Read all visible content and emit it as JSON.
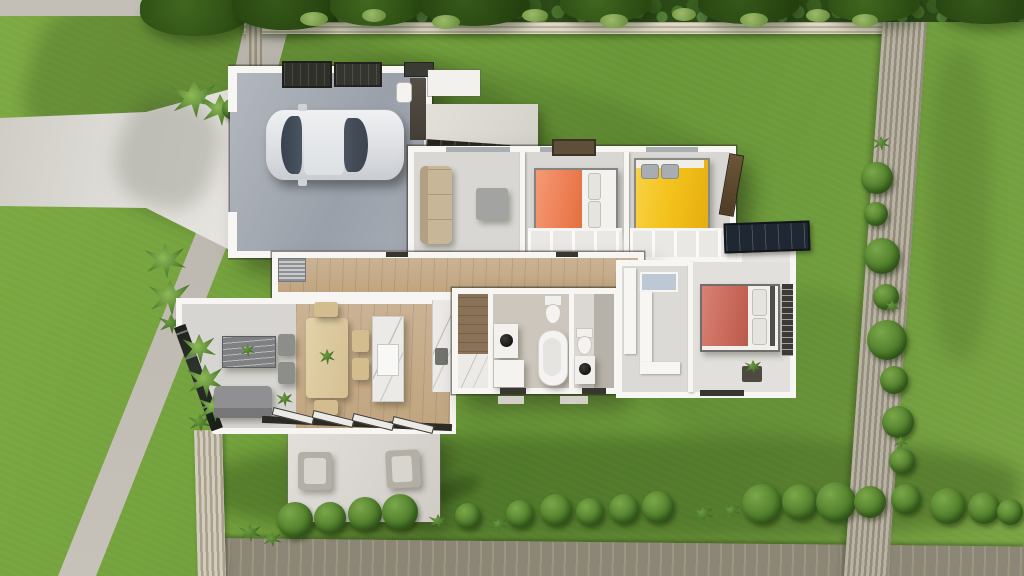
{
  "scene": {
    "type": "3d-aerial-architectural-render",
    "description": "Top-down 3D render of a single-storey house with the roof cut away, sitting on a fenced lawn with driveway, sidewalk, patio, rear deck and garden hedges",
    "time_of_day": "daylight with long tree shadows from upper left"
  },
  "palette": {
    "grass": "#6f9c3a",
    "grass_shadow": "#3f6320",
    "sidewalk": "#bab6ae",
    "driveway": "#dcd9d3",
    "deck": "#94907f",
    "fence_top": "#d6d0bf",
    "fence_right": "#aba695",
    "wall": "#f7f6f2",
    "garage_floor": "#a9afb7",
    "wood_floor": "#c7ae8b",
    "tile": "#cdc6bc",
    "marble": "#eceae6",
    "bed_orange": "#f18a61",
    "bed_yellow": "#f4c31d",
    "bed_red": "#cd7263",
    "sofa_beige": "#c8b698",
    "sofa_gray": "#8b8b89",
    "solar_panel": "#1f2832",
    "car": "#e9eaec",
    "hedge": "#2c4a18",
    "bush": "#4c7a28"
  },
  "exterior": {
    "lawn": {
      "coverage": "full lot"
    },
    "paths": [
      {
        "id": "top-road-strip",
        "material": "concrete"
      },
      {
        "id": "sidewalk",
        "material": "concrete",
        "orientation": "vertical, slanting left toward bottom"
      },
      {
        "id": "driveway",
        "material": "concrete",
        "connects": "street to garage"
      }
    ],
    "patio": {
      "material": "concrete",
      "chairs": 2
    },
    "deck": {
      "material": "timber boards",
      "position": "along bottom edge"
    },
    "fences": [
      {
        "side": "top",
        "style": "horizontal slat with hedge behind"
      },
      {
        "side": "right",
        "style": "vertical slat, slanting"
      },
      {
        "side": "bottom-left",
        "style": "vertical slat"
      }
    ],
    "vegetation": {
      "top_hedge": "dense shrubs along full top boundary",
      "right_bushes": 9,
      "bottom_bushes": 14,
      "agaves": 5,
      "tree_canopies": 8,
      "sunroom_palms": 3
    }
  },
  "house": {
    "style": "modern single storey, white walls, open roof cutaway",
    "solar_panel": true,
    "car": {
      "type": "sedan, top view",
      "color": "silver white"
    },
    "rooms": [
      {
        "id": "garage",
        "name": "Garage",
        "furniture": [
          "car"
        ]
      },
      {
        "id": "lounge",
        "name": "Lounge",
        "furniture": [
          "beige sofa",
          "gray ottoman"
        ]
      },
      {
        "id": "bedroom-1",
        "name": "Bedroom 1",
        "bed_color": "#f18a61"
      },
      {
        "id": "bedroom-2",
        "name": "Bedroom 2",
        "bed_color": "#f4c31d"
      },
      {
        "id": "hallway",
        "name": "Hallway"
      },
      {
        "id": "open-plan",
        "name": "Open plan living dining kitchen",
        "furniture": [
          "gray sofa",
          "wave-front sideboard",
          "dining table with chairs",
          "kitchen island with sink",
          "wall counter"
        ]
      },
      {
        "id": "laundry",
        "name": "Laundry"
      },
      {
        "id": "bathroom",
        "name": "Bathroom",
        "fixtures": [
          "vanity with black bowl",
          "toilet",
          "freestanding tub"
        ]
      },
      {
        "id": "wc",
        "name": "WC",
        "fixtures": [
          "toilet",
          "unit with black bowl"
        ]
      },
      {
        "id": "walk-in-robe",
        "name": "Walk-in robe"
      },
      {
        "id": "master-bedroom",
        "name": "Master bedroom",
        "bed_color": "#cd7263",
        "extras": [
          "louvre window",
          "planter"
        ]
      },
      {
        "id": "entry-court",
        "name": "Entry courtyard"
      },
      {
        "id": "patio",
        "name": "Patio",
        "furniture": [
          "two outdoor armchairs"
        ]
      }
    ]
  }
}
